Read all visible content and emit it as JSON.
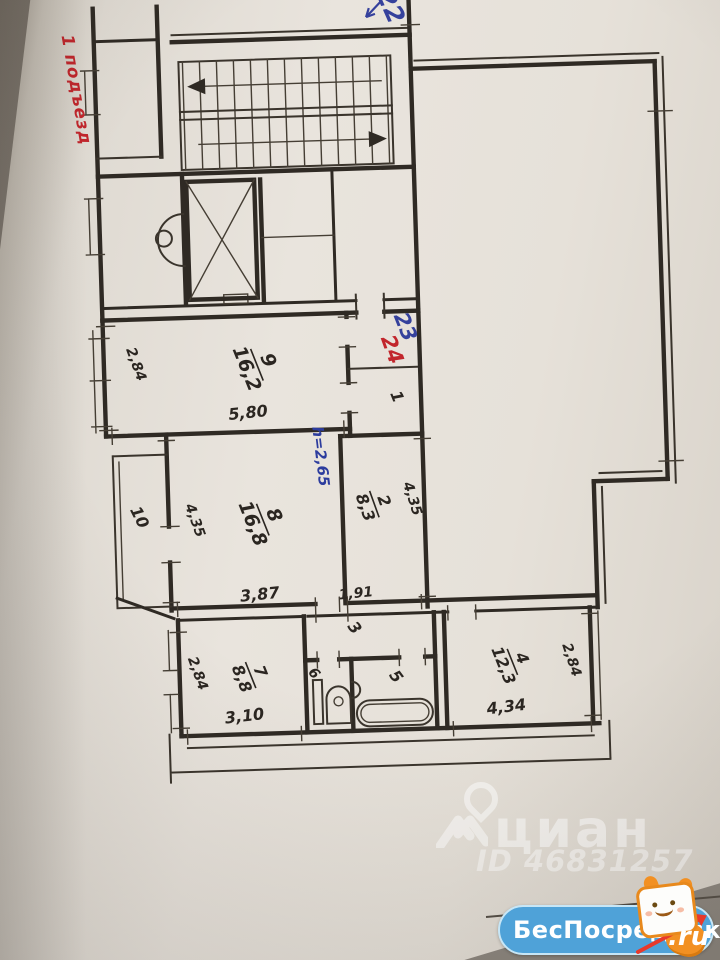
{
  "plan": {
    "entrance_label": "1 подъезд",
    "apartment_numbers": {
      "apt22": "22",
      "apt23": "23",
      "apt24": "24"
    },
    "ceiling_height": "h=2,65",
    "rooms": {
      "r9": {
        "num": "9",
        "area": "16,2"
      },
      "r2": {
        "num": "2",
        "area": "8,3"
      },
      "r8": {
        "num": "8",
        "area": "16,8"
      },
      "r7": {
        "num": "7",
        "area": "8,8"
      },
      "r4": {
        "num": "4",
        "area": "12,3"
      },
      "r1": "1",
      "r3": "3",
      "r5": "5",
      "r6": "6",
      "r10": "10"
    },
    "dimensions": {
      "room9_width": "2,84",
      "room9_length": "5,80",
      "room2_length": "4,35",
      "room8_width": "4,35",
      "room8_length": "3,87",
      "hall_length": "1,91",
      "room7_width": "2,84",
      "room7_length": "3,10",
      "room4_width": "2,84",
      "room4_length": "4,34"
    }
  },
  "watermark": {
    "brand": "циан",
    "listing_id": "ID 46831257"
  },
  "badge": {
    "site": "БесПосредника",
    "tld": ".ru"
  },
  "colors": {
    "ink": "#2f2a24",
    "red": "#c2262c",
    "blue": "#35419c",
    "badge_blue": "#4fa2d8",
    "mascot_orange": "#f29022",
    "paper": "#e9e4dd"
  }
}
